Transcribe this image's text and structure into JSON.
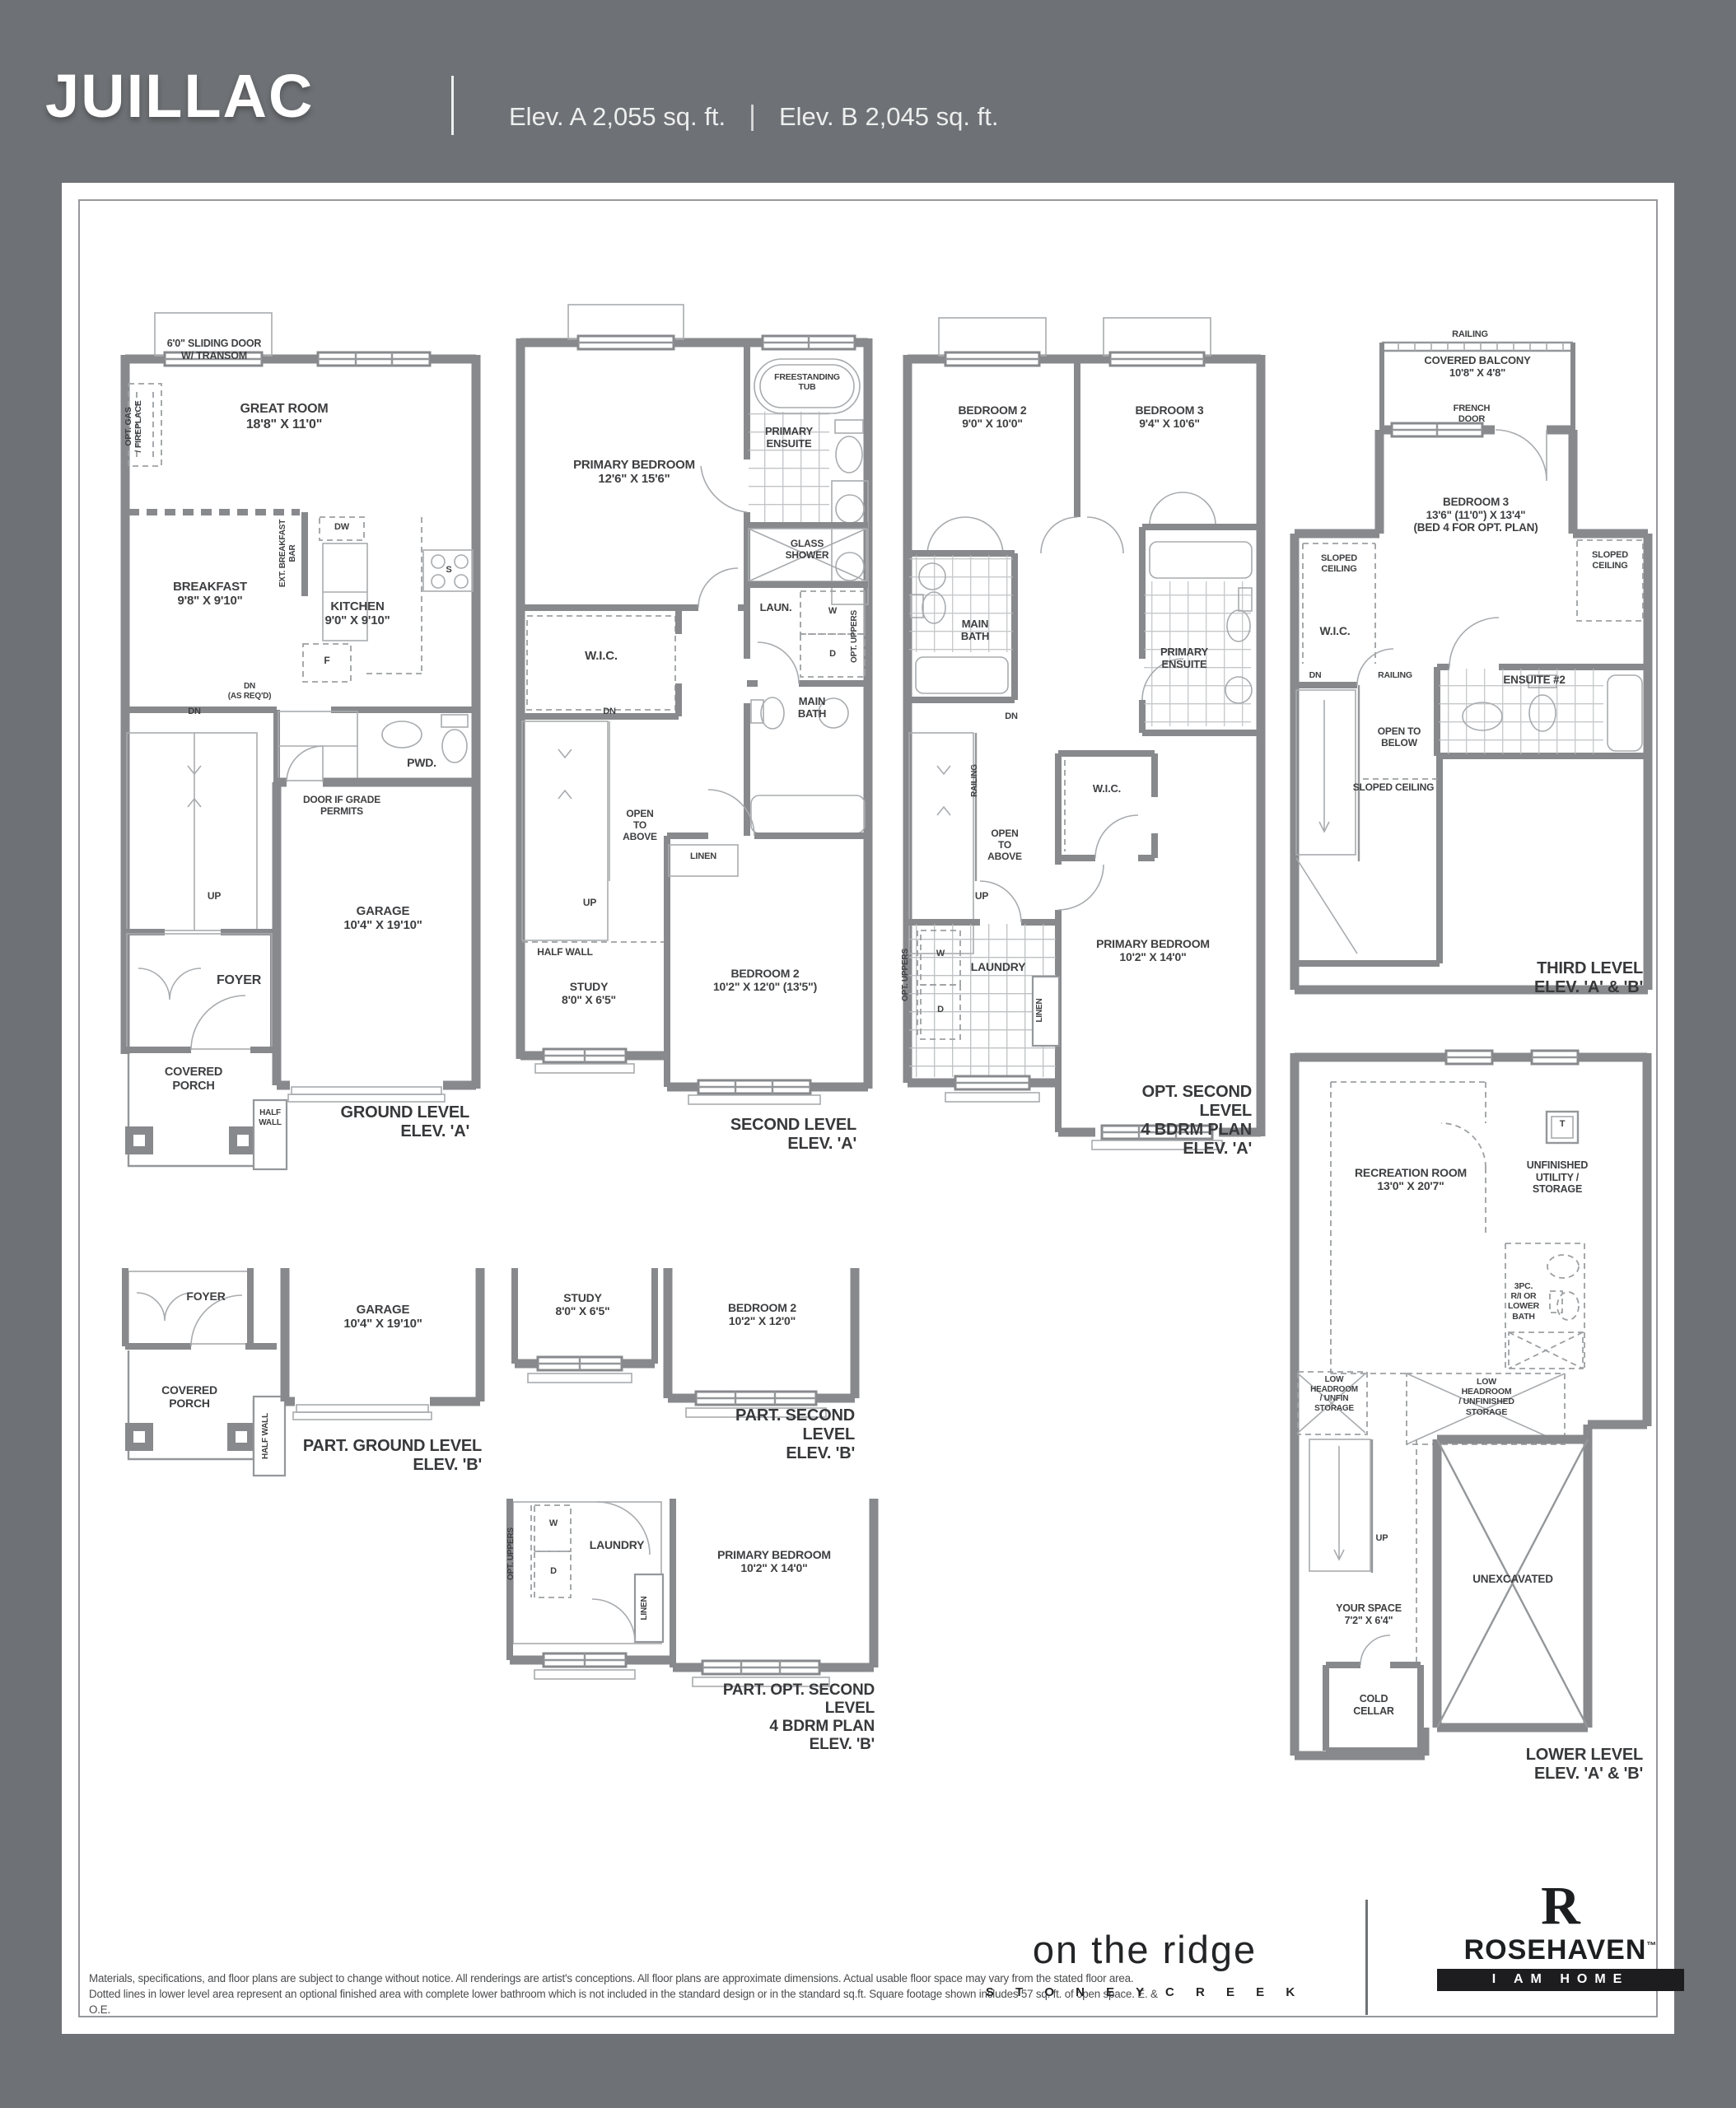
{
  "header": {
    "model_name": "JUILLAC",
    "elev_a": "Elev. A  2,055 sq. ft.",
    "pipe": "|",
    "elev_b": "Elev. B  2,045 sq. ft."
  },
  "plans": {
    "ground_a": {
      "title": "GROUND LEVEL\nELEV. 'A'",
      "labels": {
        "sliding_door": "6'0\" SLIDING DOOR\nW/ TRANSOM",
        "opt_gas_fireplace": "OPT. GAS\n/ FIREPLACE",
        "great_room": "GREAT ROOM\n18'8\" X 11'0\"",
        "breakfast": "BREAKFAST\n9'8\" X 9'10\"",
        "ext_breakfast_bar": "EXT. BREAKFAST BAR",
        "dw": "DW",
        "stove": "S",
        "kitchen": "KITCHEN\n9'0\" X 9'10\"",
        "fridge": "F",
        "dn": "DN",
        "dn_as_reqd": "DN\n(AS REQ'D)",
        "powder": "PWD.",
        "door_if_grade": "DOOR IF GRADE\nPERMITS",
        "up": "UP",
        "garage": "GARAGE\n10'4\" X 19'10\"",
        "foyer": "FOYER",
        "covered_porch": "COVERED\nPORCH",
        "half_wall": "HALF\nWALL"
      }
    },
    "second_a": {
      "title": "SECOND LEVEL\nELEV. 'A'",
      "labels": {
        "freestanding_tub": "FREESTANDING\nTUB",
        "primary_ensuite": "PRIMARY\nENSUITE",
        "primary_bedroom": "PRIMARY BEDROOM\n12'6\" X 15'6\"",
        "glass_shower": "GLASS\nSHOWER",
        "wic": "W.I.C.",
        "laun": "LAUN.",
        "w": "W",
        "d": "D",
        "opt_uppers": "OPT. UPPERS",
        "main_bath": "MAIN\nBATH",
        "dn": "DN",
        "open_to_above": "OPEN\nTO\nABOVE",
        "up": "UP",
        "half_wall": "HALF WALL",
        "linen": "LINEN",
        "study": "STUDY\n8'0\" X 6'5\"",
        "bedroom2": "BEDROOM 2\n10'2\" X 12'0\" (13'5\")"
      }
    },
    "opt_second_a": {
      "title": "OPT. SECOND LEVEL\n4 BDRM PLAN\nELEV. 'A'",
      "labels": {
        "bedroom2": "BEDROOM 2\n9'0\" X 10'0\"",
        "bedroom3": "BEDROOM 3\n9'4\" X 10'6\"",
        "main_bath": "MAIN\nBATH",
        "primary_ensuite": "PRIMARY\nENSUITE",
        "dn": "DN",
        "railing": "RAILING",
        "open_to_above": "OPEN\nTO\nABOVE",
        "up": "UP",
        "wic": "W.I.C.",
        "opt_uppers": "OPT. UPPERS",
        "w": "W",
        "d": "D",
        "laundry": "LAUNDRY",
        "linen": "LINEN",
        "primary_bedroom": "PRIMARY BEDROOM\n10'2\" X 14'0\""
      }
    },
    "third_ab": {
      "title": "THIRD LEVEL\nELEV. 'A' & 'B'",
      "labels": {
        "railing_top": "RAILING",
        "covered_balcony": "COVERED BALCONY\n10'8\" X 4'8\"",
        "french_door": "FRENCH\nDOOR",
        "bedroom3": "BEDROOM 3\n13'6\" (11'0\") X 13'4\"\n(BED 4 FOR OPT. PLAN)",
        "sloped_ceiling_left": "SLOPED\nCEILING",
        "sloped_ceiling_right": "SLOPED\nCEILING",
        "wic": "W.I.C.",
        "ensuite2": "ENSUITE #2",
        "dn": "DN",
        "railing2": "RAILING",
        "open_to_below": "OPEN TO\nBELOW",
        "sloped_ceiling3": "SLOPED CEILING"
      }
    },
    "part_ground_b": {
      "title": "PART. GROUND LEVEL\nELEV. 'B'",
      "labels": {
        "foyer": "FOYER",
        "garage": "GARAGE\n10'4\" X 19'10\"",
        "covered_porch": "COVERED\nPORCH",
        "half_wall": "HALF WALL"
      }
    },
    "part_second_b": {
      "title": "PART. SECOND LEVEL\nELEV. 'B'",
      "labels": {
        "study": "STUDY\n8'0\" X 6'5\"",
        "bedroom2": "BEDROOM 2\n10'2\" X 12'0\""
      }
    },
    "part_opt_second_b": {
      "title": "PART. OPT. SECOND LEVEL\n4 BDRM PLAN\nELEV. 'B'",
      "labels": {
        "opt_uppers": "OPT. UPPERS",
        "w": "W",
        "d": "D",
        "laundry": "LAUNDRY",
        "linen": "LINEN",
        "primary_bedroom": "PRIMARY BEDROOM\n10'2\" X 14'0\""
      }
    },
    "lower_ab": {
      "title": "LOWER LEVEL\nELEV. 'A' & 'B'",
      "labels": {
        "recreation_room": "RECREATION ROOM\n13'0\" X 20'7\"",
        "t": "T",
        "unfinished_utility": "UNFINISHED\nUTILITY /\nSTORAGE",
        "threepc_bath": "3PC.\nR/I OR\nLOWER\nBATH",
        "low_headroom_unfin": "LOW\nHEADROOM\n/ UNFIN\nSTORAGE",
        "low_headroom_unfinished": "LOW\nHEADROOM\n/ UNFINISHED\nSTORAGE",
        "up": "UP",
        "your_space": "YOUR SPACE\n7'2\" X 6'4\"",
        "cold_cellar": "COLD\nCELLAR",
        "unexcavated": "UNEXCAVATED"
      }
    }
  },
  "footer": {
    "disclaimer": "Materials, specifications, and floor plans are subject to change without notice. All renderings are artist's conceptions. All floor plans are approximate dimensions. Actual usable floor space may vary from the stated floor area. Dotted lines in lower level area represent an optional finished area with complete lower bathroom which is not included in the standard design or in the standard sq.ft. Square footage shown includes 57 sq. ft. of open space. E. & O.E.",
    "community": {
      "name": "on the ridge",
      "location": "S T O N E Y   C R E E K"
    },
    "builder": {
      "monogram": "R",
      "name": "ROSEHAVEN",
      "tm": "™",
      "tagline": "I AM HOME"
    }
  }
}
